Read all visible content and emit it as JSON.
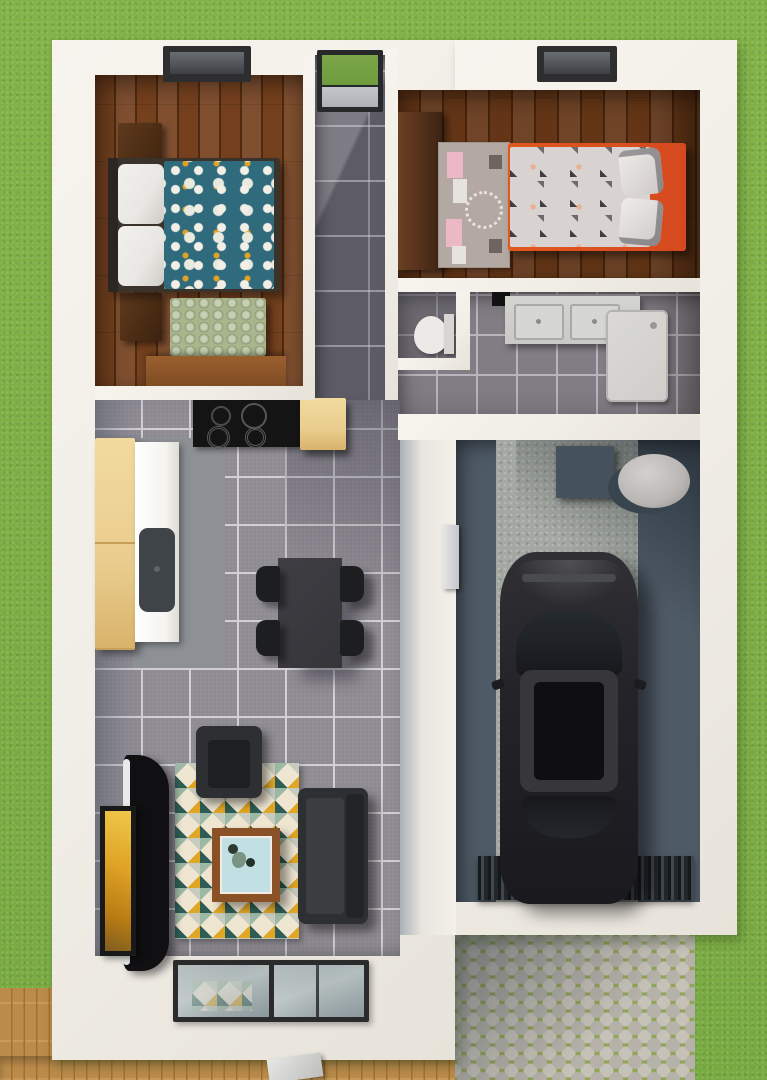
{
  "scene": {
    "description": "3D rendered top-down floor plan of a small house on a lawn",
    "exterior": {
      "lawn": "grass surrounding the house",
      "deck": "wooden deck along bottom-left",
      "driveway": "cobblestone driveway at bottom-right",
      "entry_door": "glass entry door at top of hallway showing grass"
    },
    "rooms": [
      {
        "name": "master-bedroom",
        "floor": "dark wood planks",
        "furniture": [
          "double bed with teal floral duvet and white pillows",
          "two dark wood nightstands",
          "sage green bench",
          "wood dresser",
          "ceiling window"
        ]
      },
      {
        "name": "hallway",
        "floor": "dark grey tile",
        "furniture": [
          "glass entry door"
        ]
      },
      {
        "name": "kids-bedroom",
        "floor": "dark wood planks",
        "furniture": [
          "dark wardrobe",
          "pink play rug",
          "bed with orange frame and grey triangle bedding",
          "ceiling window"
        ]
      },
      {
        "name": "bathroom",
        "floor": "grey tile",
        "furniture": [
          "toilet in WC nook",
          "double-sink concrete vanity",
          "shower tray"
        ]
      },
      {
        "name": "kitchen-dining",
        "floor": "grey tile",
        "furniture": [
          "black cooktop with four burners",
          "tan cabinets",
          "white counter with dark sink",
          "dark dining table",
          "four black chairs"
        ]
      },
      {
        "name": "living-room",
        "floor": "grey tile",
        "furniture": [
          "geometric triangle rug",
          "dark armchair",
          "dark sofa",
          "wood coffee table with glass top",
          "curved black TV stand",
          "wall art",
          "sliding glass door"
        ]
      },
      {
        "name": "garage",
        "floor": "dark concrete with light center strip",
        "furniture": [
          "black car",
          "water heater box",
          "grey boiler tank",
          "side door",
          "ribbed garage door grate"
        ]
      }
    ]
  },
  "palette": {
    "grass": "#7cae45",
    "cobble": "#b6b2aa",
    "cobbleJoint": "#8fa455",
    "deck": "#c4924f",
    "deckSeam": "#a3712f",
    "wall": "#f0ede6",
    "woodMaster": "#74401e",
    "woodMasterDark": "#4f2a10",
    "woodKids": "#643617",
    "woodKidsDark": "#45230c",
    "tile": "#8f8b93",
    "tileGrout": "#d2cfd5",
    "hallTile": "#5d5c66",
    "duvet": "#2f6b7c",
    "pillow": "#e9e7e3",
    "bench": "#a9b58c",
    "nightstand": "#4a2c13",
    "bedFrame": "#3a332c",
    "kidsOrange": "#d6491f",
    "kidsBedding": "#d8d3d1",
    "kidsRug": "#b3a9a2",
    "kidsRugPink": "#ecb8c6",
    "wardrobe": "#53301b",
    "cooktop": "#141414",
    "cabinet": "#e9cd8e",
    "counter": "#f4f3ef",
    "sink": "#3f4449",
    "table": "#35353a",
    "chair": "#1d1e20",
    "sofa": "#2e2f32",
    "sofaSeat": "#3c3d41",
    "rugYellow": "#e0a626",
    "rugTeal": "#2f5d55",
    "rugSage": "#9db8a4",
    "rugCream": "#efe6d2",
    "coffeeWood": "#8a5127",
    "coffeeGlass": "#c2dfe3",
    "tv": "#101012",
    "artYellow": "#dfa325",
    "garageFloor": "#4e5a66",
    "garageStrip": "#a3a8a2",
    "car": "#242428",
    "carGlass": "#17181c",
    "tank": "#b9b6b3",
    "heater": "#45525b",
    "grate": "#2f3439",
    "vanity": "#c9c9c5",
    "basin": "#d6d6d2",
    "shower": "#cfcecb",
    "toilet": "#eceae6",
    "doorGlass": "#6f9c3f",
    "glass": "#b4bebe"
  }
}
